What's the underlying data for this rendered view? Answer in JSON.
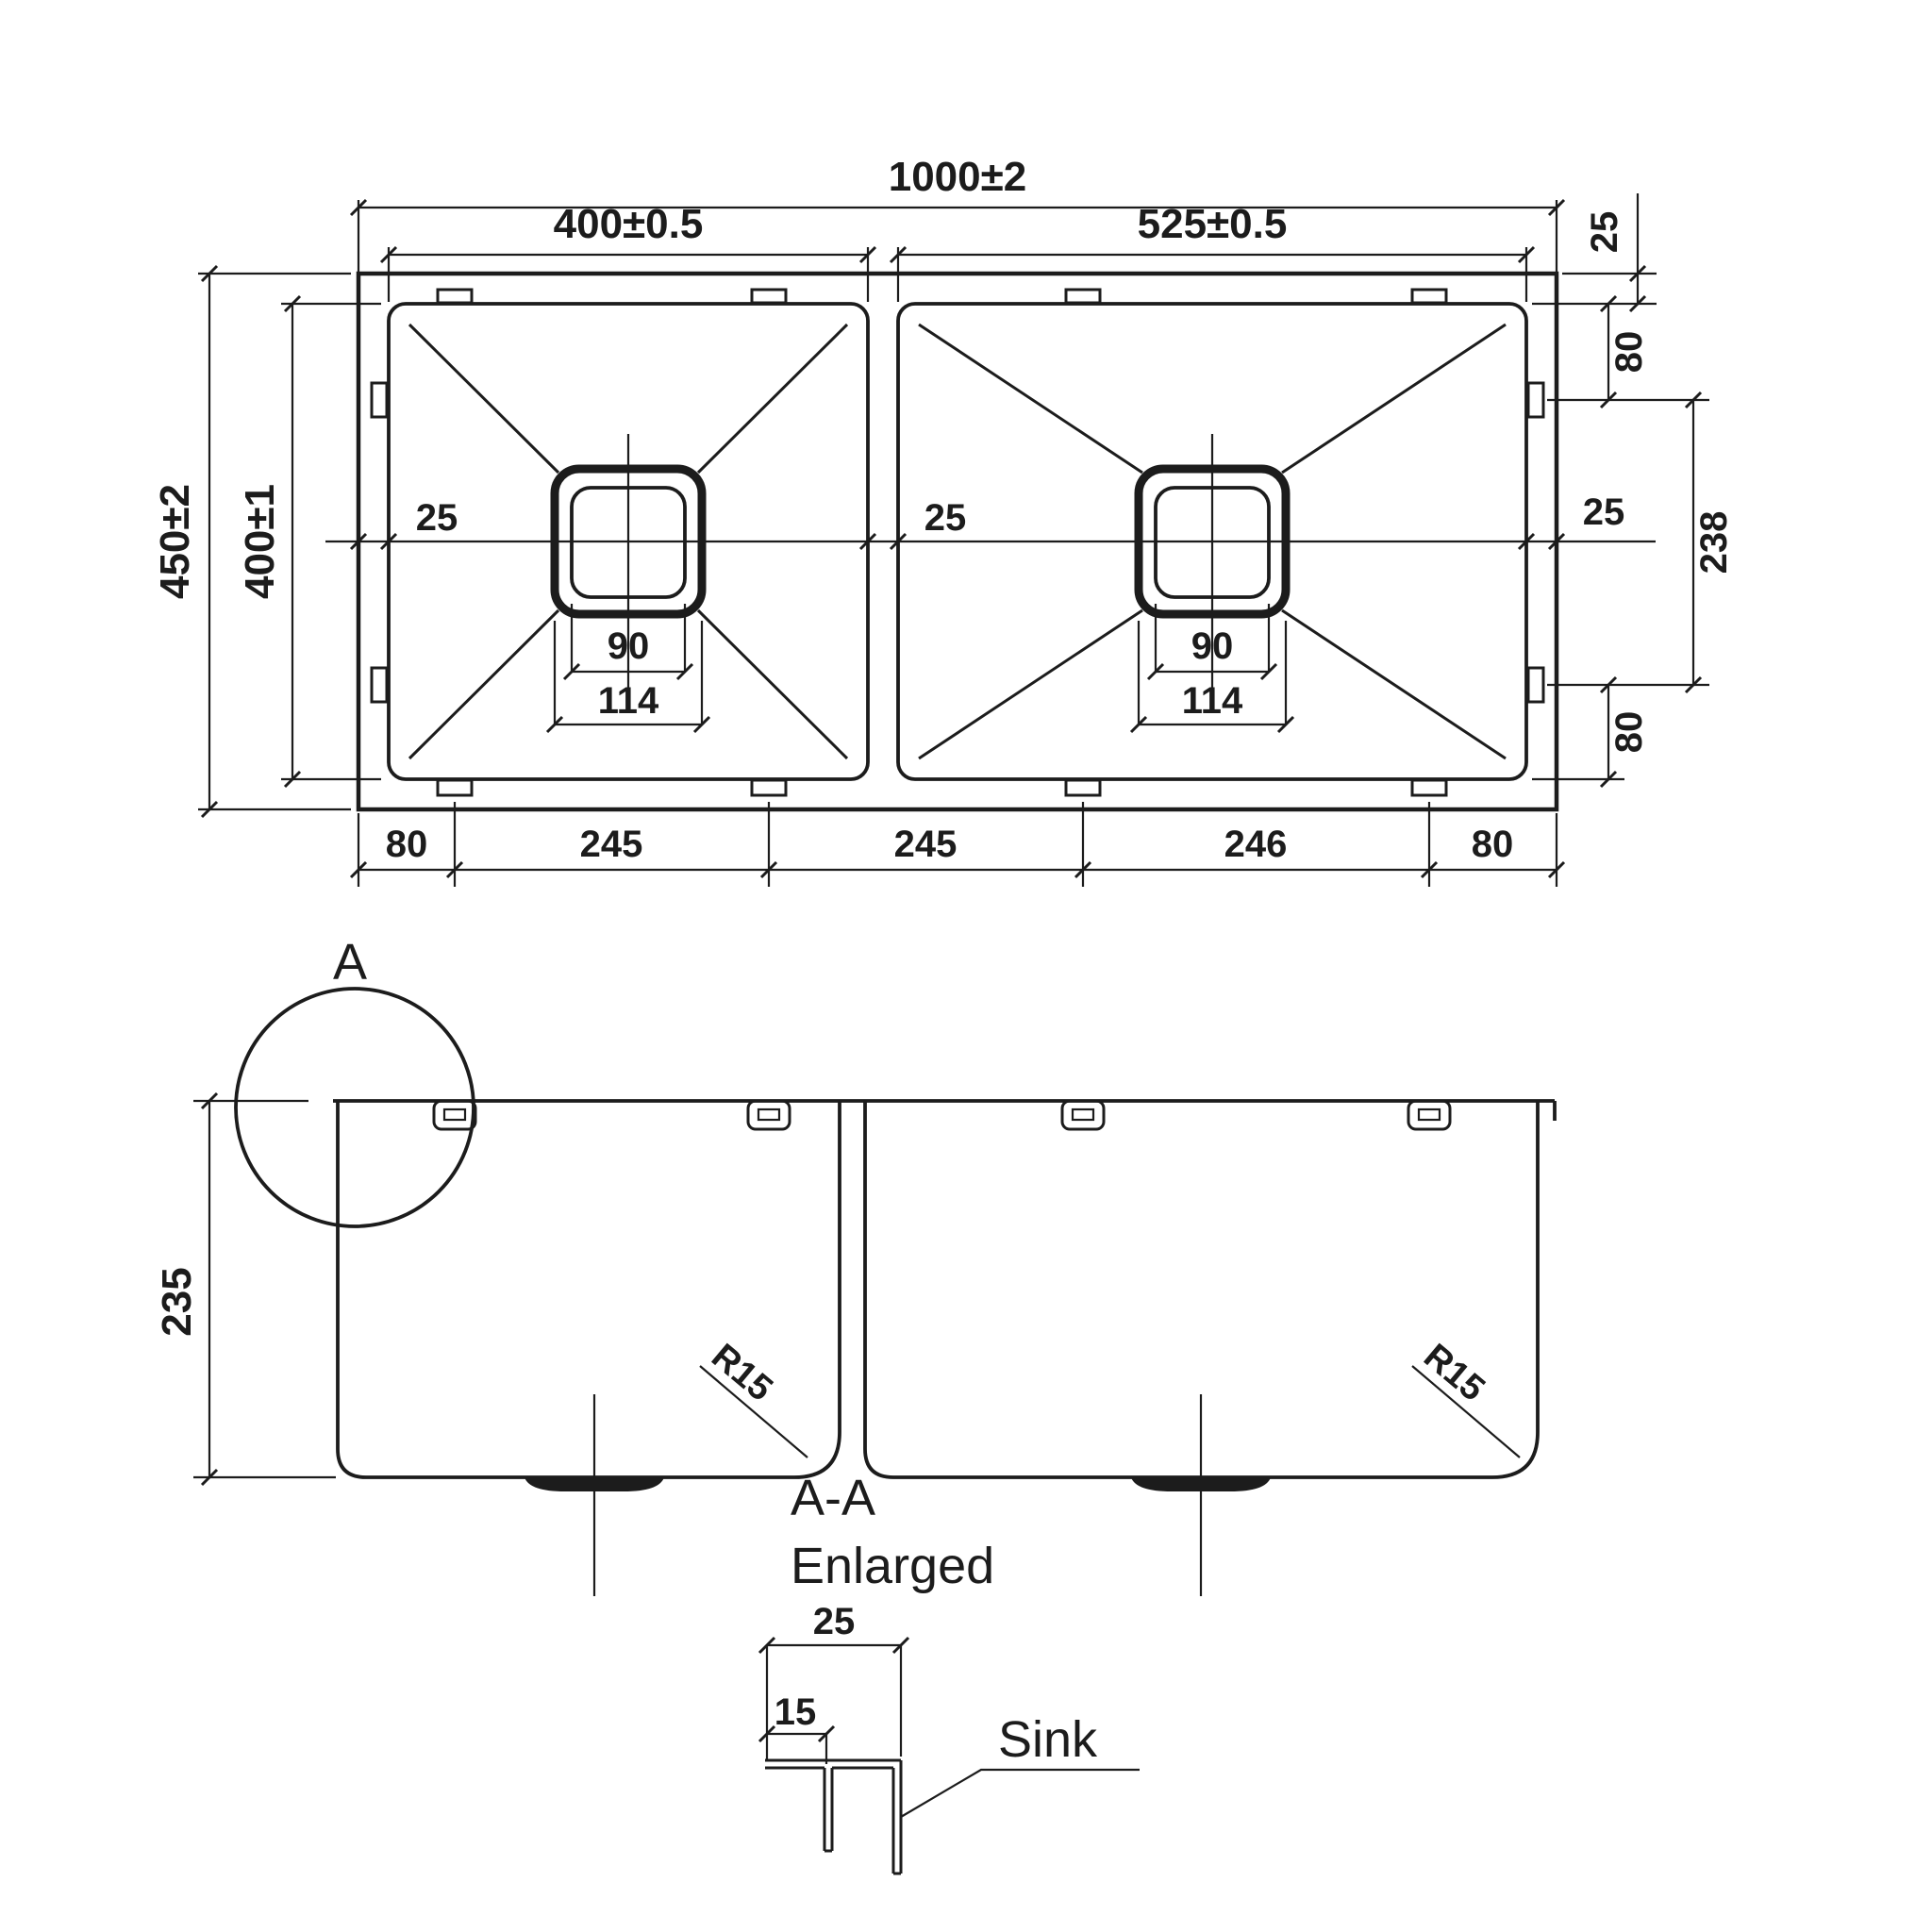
{
  "drawing_title": "Double bowl sink technical drawing",
  "colors": {
    "line": "#1c1c1c",
    "background": "#ffffff"
  },
  "top_view": {
    "overall_width": "1000±2",
    "left_bowl_width": "400±0.5",
    "right_bowl_width": "525±0.5",
    "overall_depth": "450±2",
    "bowl_depth": "400±1",
    "rim_left_label": "25",
    "rim_divider_label": "25",
    "rim_right_label": "25",
    "drains": {
      "left": {
        "inner": "90",
        "outer": "114"
      },
      "right": {
        "inner": "90",
        "outer": "114"
      }
    },
    "right_side": {
      "top_rim": "25",
      "top_clip_offset": "80",
      "clip_span": "238",
      "bottom_clip_offset": "80"
    },
    "bottom": {
      "s1": "80",
      "s2": "245",
      "s3": "245",
      "s4": "246",
      "s5": "80"
    }
  },
  "section_view": {
    "detail_marker": "A",
    "bowl_depth": "235",
    "radius_left": "R15",
    "radius_right": "R15"
  },
  "detail_view": {
    "title_line1": "A-A",
    "title_line2": "Enlarged",
    "flange_width": "25",
    "lip_width": "15",
    "callout": "Sink"
  }
}
